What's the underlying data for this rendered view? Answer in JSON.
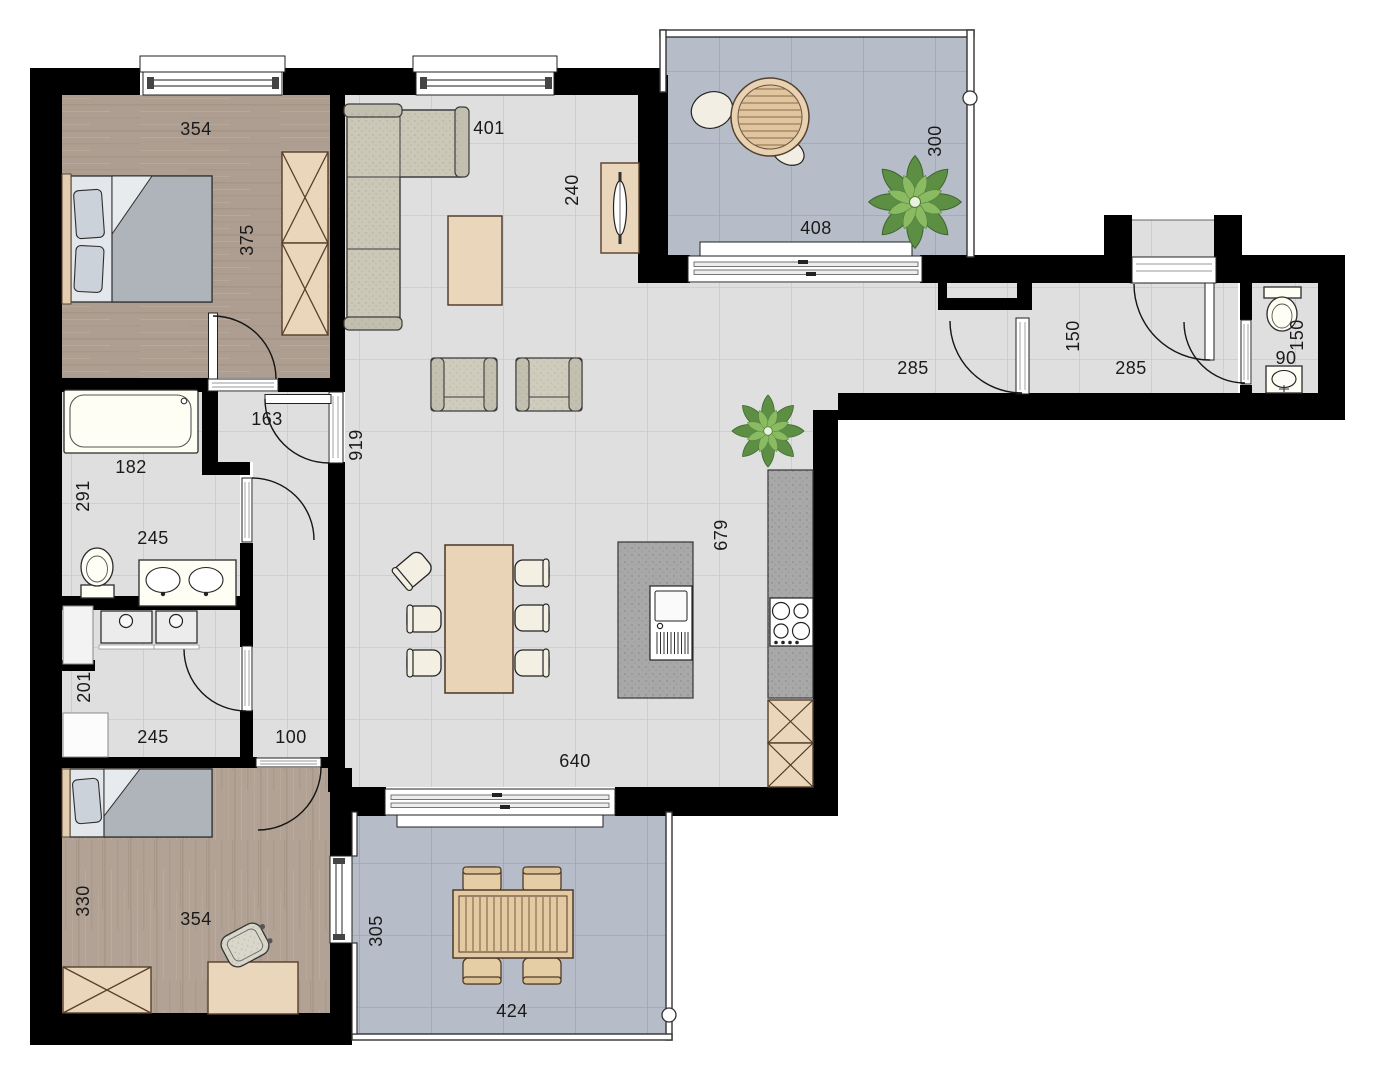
{
  "plan": {
    "title": "apartment-floor-plan",
    "background": "#ffffff",
    "wall_color": "#000000",
    "floor_colors": {
      "living_tile": "#e0e0e0",
      "terrace_tile": "#b6bdc8",
      "bedroom_wood": "#b1a295",
      "furniture_wood": "#e9d4b8",
      "sofa_fabric": "#cbc8b8",
      "counter_gray": "#a8a8a8",
      "plant_green": "#5c8f44"
    },
    "rooms": [
      {
        "name": "bedroom-1",
        "furniture": [
          "double-bed",
          "wardrobe"
        ],
        "dims": [
          "354",
          "375"
        ]
      },
      {
        "name": "living-dining-kitchen",
        "furniture": [
          "corner-sofa",
          "coffee-table",
          "armchair",
          "armchair",
          "sideboard",
          "dining-table",
          "six-chairs",
          "kitchen-island-with-sink",
          "kitchen-counter-with-hob",
          "base-cabinets",
          "plant"
        ],
        "dims": [
          "401",
          "240",
          "919",
          "679",
          "640"
        ]
      },
      {
        "name": "terrace-top",
        "furniture": [
          "round-table",
          "lounge-cushions",
          "plant"
        ],
        "dims": [
          "408",
          "300"
        ]
      },
      {
        "name": "entrance-hall",
        "furniture": [],
        "dims": [
          "285",
          "150",
          "285"
        ]
      },
      {
        "name": "wc",
        "furniture": [
          "toilet",
          "washbasin"
        ],
        "dims": [
          "90",
          "150"
        ]
      },
      {
        "name": "hall",
        "furniture": [],
        "dims": [
          "163",
          "100"
        ]
      },
      {
        "name": "bathroom",
        "furniture": [
          "bathtub",
          "toilet",
          "double-washbasin"
        ],
        "dims": [
          "182",
          "291",
          "245"
        ]
      },
      {
        "name": "utility-room",
        "furniture": [
          "washing-machine",
          "dryer",
          "cabinet"
        ],
        "dims": [
          "201",
          "245"
        ]
      },
      {
        "name": "bedroom-2",
        "furniture": [
          "single-bed",
          "wardrobe",
          "desk",
          "chair"
        ],
        "dims": [
          "330",
          "354"
        ]
      },
      {
        "name": "terrace-bottom",
        "furniture": [
          "garden-table",
          "four-chairs"
        ],
        "dims": [
          "305",
          "424"
        ]
      }
    ]
  },
  "dims": {
    "bedroom1_width": "354",
    "bedroom1_depth": "375",
    "living_width": "401",
    "sideboard_wall": "240",
    "living_left_depth": "919",
    "terrace1_width": "408",
    "terrace1_depth": "300",
    "hall_seg1": "285",
    "hall_width": "150",
    "hall_seg2": "285",
    "wc_width": "90",
    "wc_depth": "150",
    "hall163_width": "163",
    "bathtub_length": "182",
    "bathroom_depth": "291",
    "bathroom_width": "245",
    "utility_depth": "201",
    "utility_width": "245",
    "corridor_width": "100",
    "kitchen_side_depth": "679",
    "living_bottom_width": "640",
    "bedroom2_depth": "330",
    "bedroom2_width": "354",
    "terrace2_depth": "305",
    "terrace2_width": "424"
  }
}
